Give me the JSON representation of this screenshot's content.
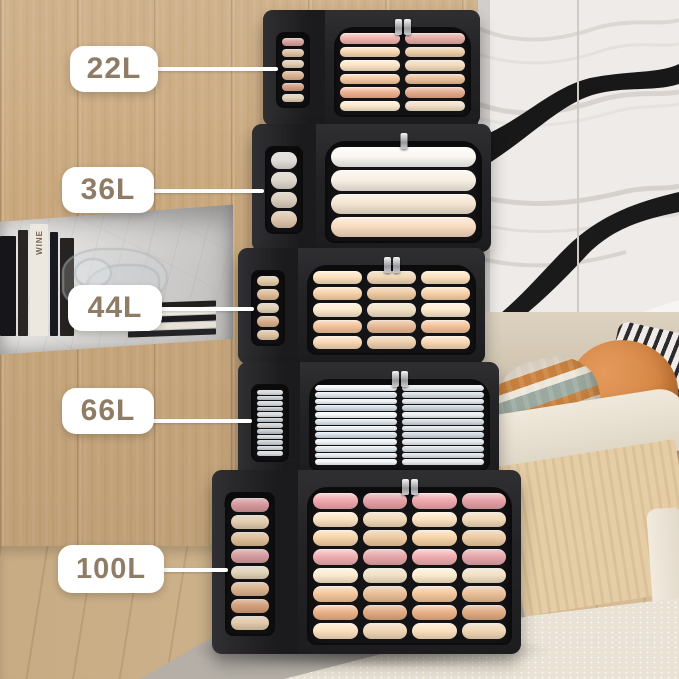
{
  "scene_title": "Stackable clothes storage boxes capacity comparison",
  "labels": [
    {
      "text": "22L"
    },
    {
      "text": "36L"
    },
    {
      "text": "44L"
    },
    {
      "text": "66L"
    },
    {
      "text": "100L"
    }
  ],
  "label_style": {
    "background": "#ffffff",
    "text_color": "#8f7c66",
    "connector_color": "#ffffff"
  },
  "boxes": [
    {
      "capacity": "22L",
      "cols": 2,
      "rows": 6,
      "row_colors": [
        "#f1b4ad",
        "#f9d8b2",
        "#fde5c6",
        "#f6c9a1",
        "#f0b394",
        "#fce9cf"
      ]
    },
    {
      "capacity": "36L",
      "cols": 1,
      "rows": 4,
      "row_colors": [
        "#fbf8f2",
        "#f8f0e4",
        "#f5e5d1",
        "#f9dcc1"
      ]
    },
    {
      "capacity": "44L",
      "cols": 3,
      "rows": 5,
      "row_colors": [
        "#fce1bd",
        "#f9d3a9",
        "#fdeacd",
        "#f3c39b",
        "#f9d9b5"
      ]
    },
    {
      "capacity": "66L",
      "cols": 2,
      "rows": 12,
      "row_colors": [
        "#f3f6f8",
        "#dde5ec",
        "#eef2f5",
        "#d2dce5",
        "#f6f8fa",
        "#dae2ea",
        "#e9eef2",
        "#d6dfe8",
        "#f1f4f7",
        "#dee6ed",
        "#e5ebf0",
        "#f4f6f8"
      ]
    },
    {
      "capacity": "100L",
      "cols": 4,
      "rows": 8,
      "row_colors": [
        "#f0a9ae",
        "#fce4c1",
        "#f8d4aa",
        "#f0aeb1",
        "#fdebce",
        "#f4c89e",
        "#ecb288",
        "#fce1be"
      ]
    }
  ],
  "box_fabric_color": "#232325",
  "decor": {
    "book_spine_text": "WINE"
  }
}
